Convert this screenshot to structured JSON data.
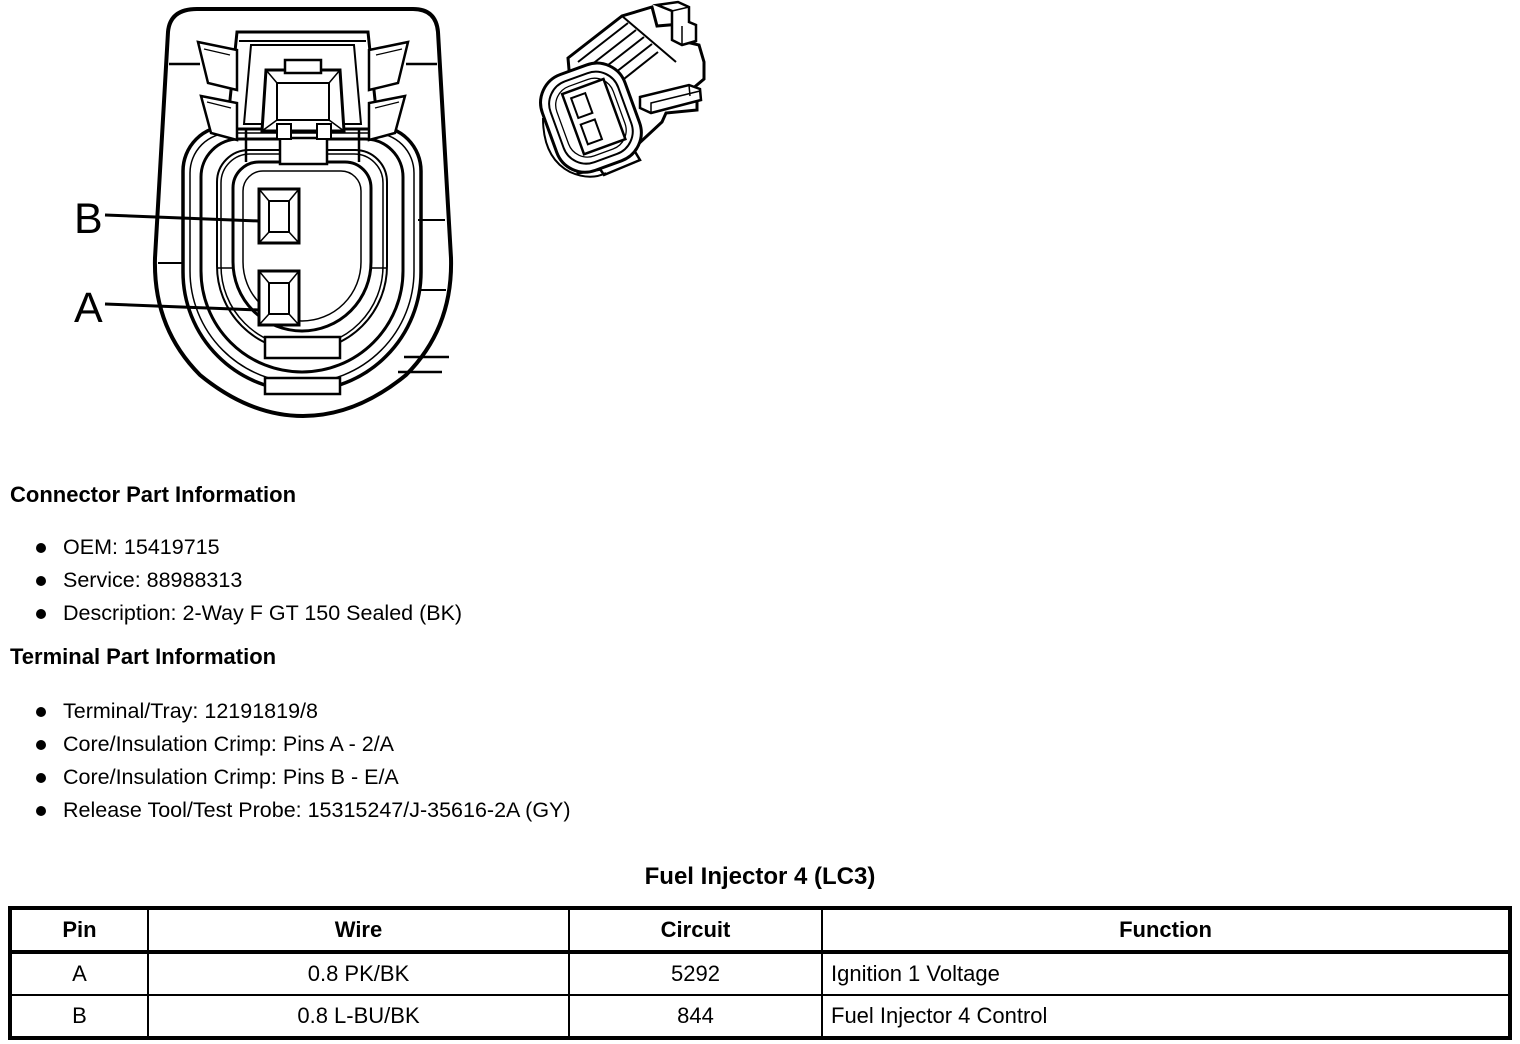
{
  "diagram": {
    "front_view": {
      "name": "connector-end-view"
    },
    "side_view": {
      "name": "connector-isometric-view"
    },
    "pin_labels": {
      "top": "B",
      "bottom": "A"
    }
  },
  "connector_part_information": {
    "heading": "Connector Part Information",
    "items": [
      "OEM: 15419715",
      "Service: 88988313",
      "Description: 2-Way F GT 150 Sealed (BK)"
    ]
  },
  "terminal_part_information": {
    "heading": "Terminal Part Information",
    "items": [
      "Terminal/Tray: 12191819/8",
      "Core/Insulation Crimp: Pins A - 2/A",
      "Core/Insulation Crimp: Pins B - E/A",
      "Release Tool/Test Probe: 15315247/J-35616-2A (GY)"
    ]
  },
  "pin_table": {
    "title": "Fuel Injector 4 (LC3)",
    "headers": [
      "Pin",
      "Wire",
      "Circuit",
      "Function"
    ],
    "rows": [
      {
        "pin": "A",
        "wire": "0.8 PK/BK",
        "circuit": "5292",
        "function": "Ignition 1 Voltage"
      },
      {
        "pin": "B",
        "wire": "0.8 L-BU/BK",
        "circuit": "844",
        "function": "Fuel Injector 4 Control"
      }
    ]
  },
  "colors": {
    "ink": "#000000",
    "paper": "#ffffff"
  }
}
